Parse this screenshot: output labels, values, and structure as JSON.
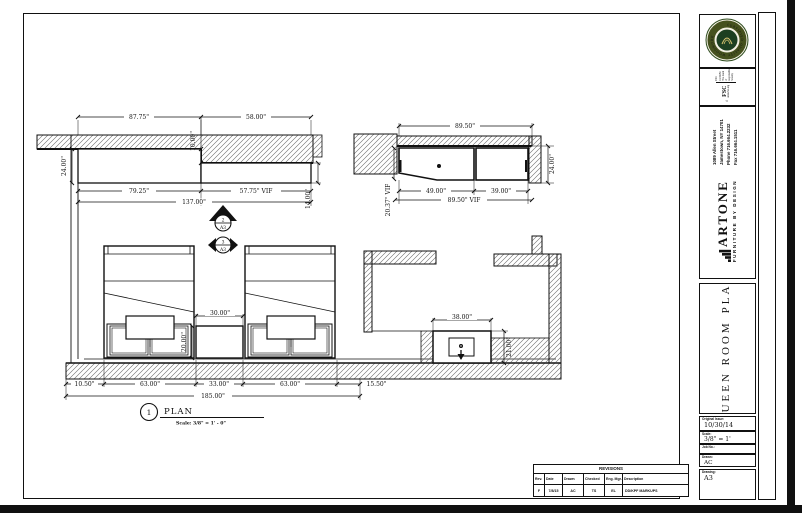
{
  "title_block": {
    "seal_text": "CERTIFIED QUALITY WOODWORK",
    "fsc": {
      "name": "FSC",
      "url": "www.fsc.org",
      "cert": "FSC C134159",
      "tagline": "The mark of responsible forestry"
    },
    "address": {
      "line1": "1089 Allen Street",
      "line2": "Jamestown, NY 14701",
      "line3": "Phone 716.664.2232",
      "line4": "Fax 716.664.1511"
    },
    "brand": {
      "name": "ARTONE",
      "tagline": "FURNITURE BY DESIGN"
    },
    "title_line1": "QUEEN ROOM",
    "title_line2": "PLAN",
    "fields": {
      "original_issue_label": "Original Issue:",
      "original_issue": "10/30/14",
      "scale_label": "Scale:",
      "scale": "3/8\" = 1'",
      "job_no_label": "Job No.:",
      "job_no": "",
      "drawn_label": "Drawn:",
      "drawn": "AC",
      "drawing_label": "Drawing:",
      "drawing": "A3"
    }
  },
  "revisions": {
    "title": "REVISIONS",
    "headers": [
      "Rev.",
      "Date",
      "Drawn",
      "Checked",
      "Eng. Mgr.",
      "Description"
    ],
    "row": {
      "rev": "F",
      "date": "7/8/15",
      "drawn": "AC",
      "checked": "TS",
      "eng_mgr": "EL",
      "description": "DD/KPF MARKUPS"
    }
  },
  "callout": {
    "number": "1",
    "title": "PLAN",
    "scale": "Scale: 3/8\" = 1' - 0\""
  },
  "markers": {
    "m1": {
      "top": "2",
      "bottom": "A3"
    },
    "m2": {
      "top": "3",
      "bottom": "A3"
    }
  },
  "dims": {
    "soffit": {
      "a": "87.75\"",
      "b": "58.00\"",
      "step": "10.00\"",
      "left": "24.00\"",
      "right": "14.00\"",
      "c": "79.25\"",
      "d": "57.75\" VIF",
      "total": "137.00\""
    },
    "credenza": {
      "top": "89.50\"",
      "left": "20.37\" VIF",
      "right": "24.00\"",
      "a": "49.00\"",
      "b": "39.00\"",
      "total": "89.50\" VIF"
    },
    "plan": {
      "g1": "10.50\"",
      "bed1": "63.00\"",
      "mid": "33.00\"",
      "bed2": "63.00\"",
      "g2": "15.50\"",
      "total": "185.00\"",
      "ns_w": "30.00\"",
      "ns_d": "20.00\"",
      "van_w": "38.00\"",
      "van_d": "21.00\""
    }
  },
  "colors": {
    "line": "#111111",
    "seal_green": "#1c3f21",
    "seal_ring": "#45511e",
    "seal_gold": "#d8c470"
  }
}
